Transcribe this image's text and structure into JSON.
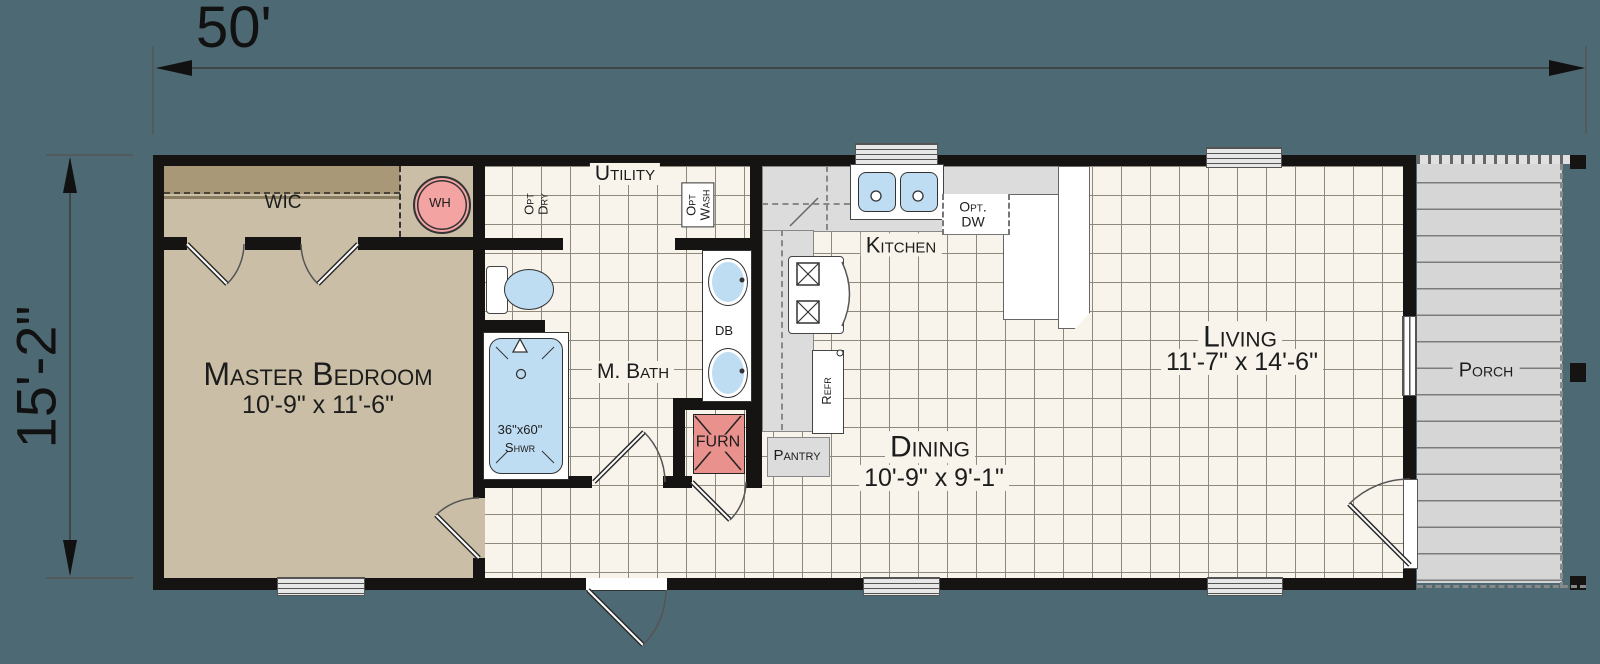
{
  "colors": {
    "bg": "#4d6973",
    "wall": "#151412",
    "tile": "#f8f4eb",
    "grid": "#8d897d",
    "tan": "#cabfa6",
    "tan-dark": "#a89877",
    "counter": "#dcdcdc",
    "blue": "#bedcf2",
    "pink": "#f2a3a2",
    "red": "#e8918d",
    "porch": "#d6d6d6",
    "plank": "#7c7c7c",
    "line": "#3a3a3a",
    "text": "#1c1c1c"
  },
  "dimensions": {
    "width": "50'",
    "height": "15'-2\""
  },
  "labels": {
    "wic": "WIC",
    "wh": "WH",
    "utility": "Utility",
    "opt_dry_1": "Opt",
    "opt_dry_2": "Dry",
    "opt_wash_1": "Opt",
    "opt_wash_2": "Wash",
    "master_bedroom": "Master Bedroom",
    "master_bedroom_size": "10'-9\" x 11'-6\"",
    "m_bath": "M. Bath",
    "shower_size": "36\"x60\"",
    "shower": "Shwr",
    "db": "DB",
    "furn": "FURN",
    "kitchen": "Kitchen",
    "opt_dw_1": "Opt.",
    "opt_dw_2": "DW",
    "refr": "Refr",
    "pantry": "Pantry",
    "dining": "Dining",
    "dining_size": "10'-9\" x 9'-1\"",
    "living": "Living",
    "living_size": "11'-7\" x 14'-6\"",
    "porch": "Porch"
  }
}
